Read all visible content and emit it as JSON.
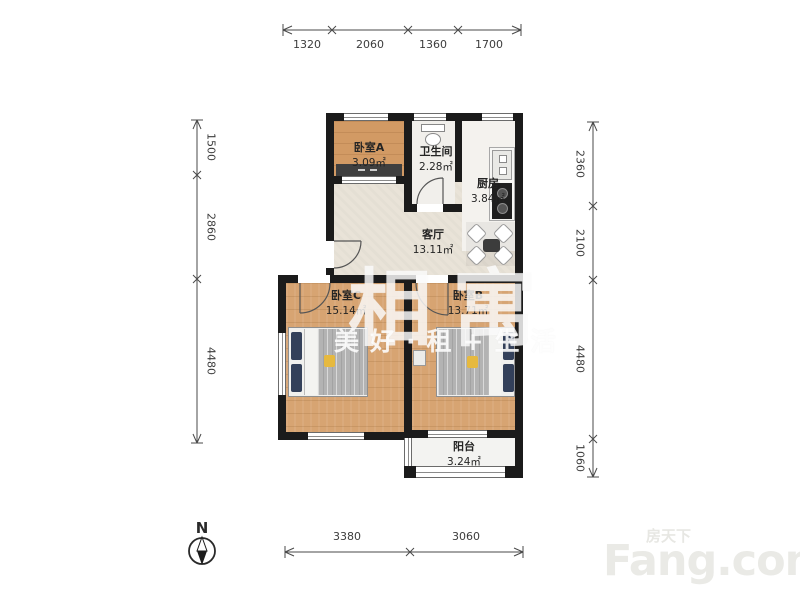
{
  "page": {
    "background": "#ffffff"
  },
  "rooms": {
    "bedroom_a": {
      "name": "卧室A",
      "area": "3.09㎡"
    },
    "bathroom": {
      "name": "卫生间",
      "area": "2.28㎡"
    },
    "kitchen": {
      "name": "厨房",
      "area": "3.84㎡"
    },
    "living_room": {
      "name": "客厅",
      "area": "13.11㎡"
    },
    "bedroom_c": {
      "name": "卧室C",
      "area": "15.14㎡"
    },
    "bedroom_b": {
      "name": "卧室B",
      "area": "13.71㎡"
    },
    "balcony": {
      "name": "阳台",
      "area": "3.24㎡"
    }
  },
  "dimensions": {
    "top": [
      "1320",
      "2060",
      "1360",
      "1700"
    ],
    "left": [
      "1500",
      "2860",
      "4480"
    ],
    "right": [
      "2360",
      "2100",
      "4480",
      "1060"
    ],
    "bottom": [
      "3380",
      "3060"
    ]
  },
  "compass": {
    "label": "N"
  },
  "watermark": {
    "brand": "相寓",
    "slogan": "美好·租+生活"
  },
  "logo": {
    "site_cn": "房天下",
    "site_en": "Fang.com"
  },
  "icons": {
    "compass": "compass-north-icon"
  },
  "colors": {
    "wall": "#1b1b1b",
    "wood_floor": "#d7a472",
    "living_floor": "#e9e3d8",
    "tile_floor": "#f1efeb",
    "pillow_navy": "#33405a",
    "blanket_gray": "#b3b3b3",
    "accent_yellow": "#e6b93f",
    "dim_text": "#3c3c3c",
    "watermark_white": "rgba(255,255,255,0.8)",
    "logo_gray": "#eaeae6"
  }
}
